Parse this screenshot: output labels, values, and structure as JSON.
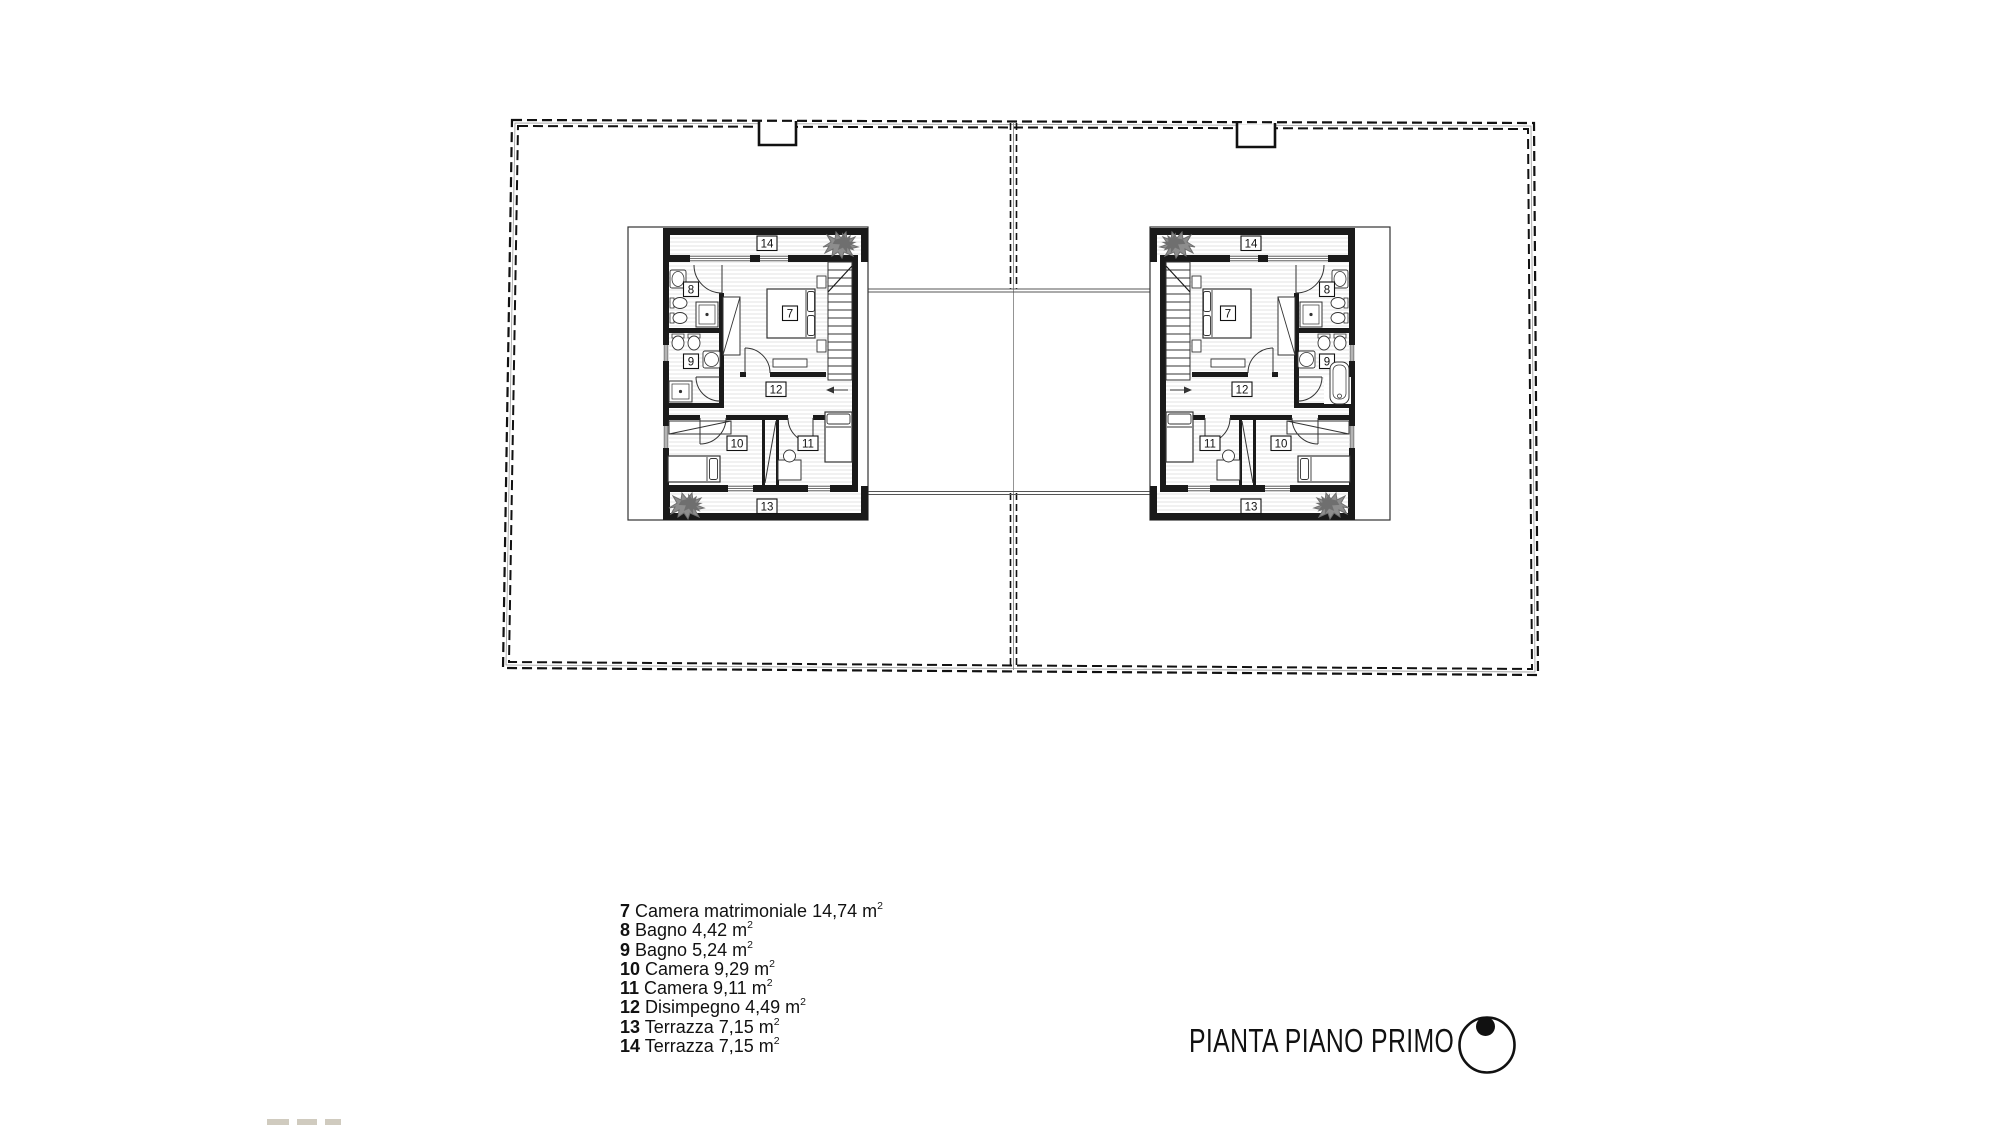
{
  "title_block": {
    "title": "PIANTA PIANO PRIMO"
  },
  "legend": {
    "items": [
      {
        "num": "7",
        "label": " Camera matrimoniale 14,74 m",
        "sup": "2"
      },
      {
        "num": "8",
        "label": " Bagno 4,42 m",
        "sup": "2"
      },
      {
        "num": "9",
        "label": " Bagno 5,24 m",
        "sup": "2"
      },
      {
        "num": "10",
        "label": " Camera 9,29 m",
        "sup": "2"
      },
      {
        "num": "11",
        "label": " Camera 9,11 m",
        "sup": "2"
      },
      {
        "num": "12",
        "label": " Disimpegno 4,49 m",
        "sup": "2"
      },
      {
        "num": "13",
        "label": " Terrazza 7,15 m",
        "sup": "2"
      },
      {
        "num": "14",
        "label": " Terrazza 7,15 m",
        "sup": "2"
      }
    ]
  },
  "plan": {
    "room_labels": {
      "r7": "7",
      "r8": "8",
      "r9": "9",
      "r10": "10",
      "r11": "11",
      "r12": "12",
      "r13": "13",
      "r14": "14"
    },
    "colors": {
      "wall": "#1a1a1a",
      "hatch": "#e0e0e0",
      "plant": "#8d8d8d"
    }
  }
}
